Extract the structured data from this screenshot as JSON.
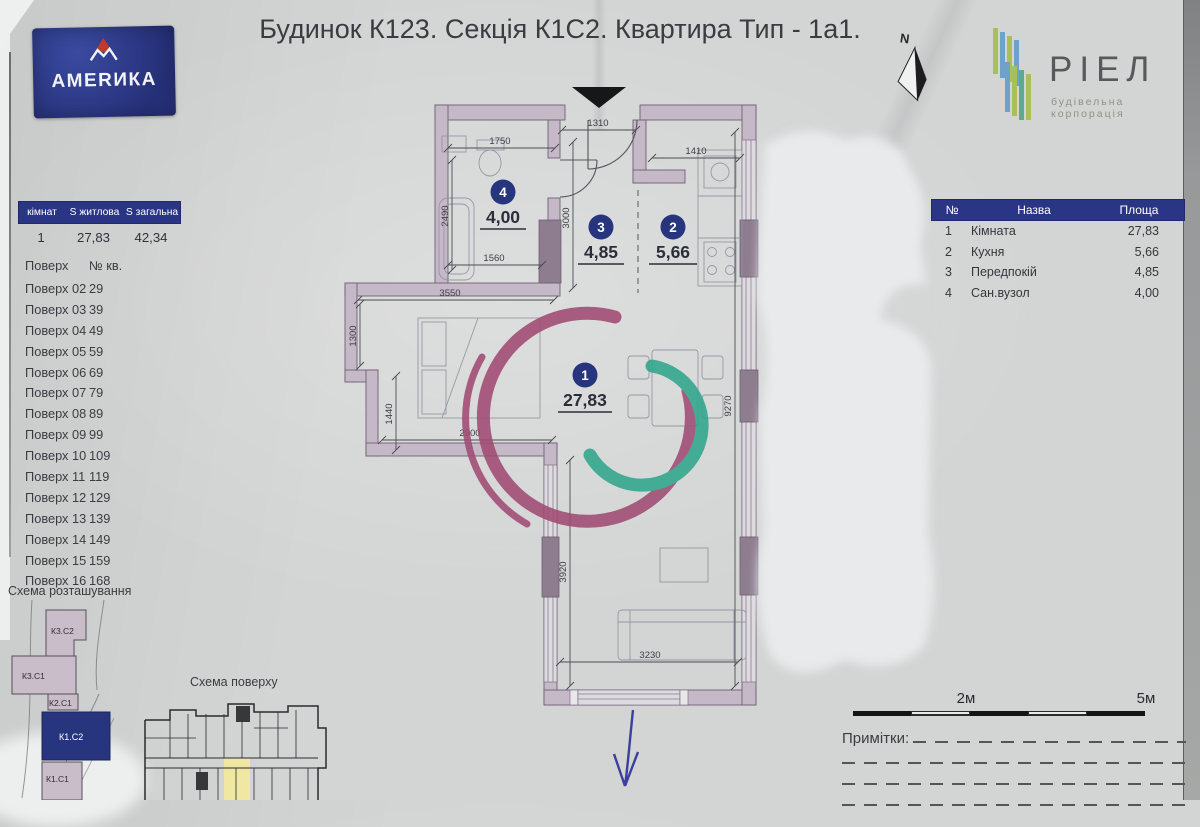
{
  "title": "Будинок К123. Секція К1С2. Квартира Тип - 1а1.",
  "amerika_logo": {
    "name": "АМЕRИКА"
  },
  "riel_logo": {
    "name": "РІЕЛ",
    "subtitle": "будівельна корпорація"
  },
  "north": {
    "label": "N"
  },
  "summary_table": {
    "headers": [
      "кімнат",
      "S житлова",
      "S загальна"
    ],
    "row": [
      "1",
      "27,83",
      "42,34"
    ]
  },
  "floors": {
    "col1": "Поверх",
    "col2": "№ кв.",
    "rows": [
      [
        "Поверх 02",
        "29"
      ],
      [
        "Поверх 03",
        "39"
      ],
      [
        "Поверх 04",
        "49"
      ],
      [
        "Поверх 05",
        "59"
      ],
      [
        "Поверх 06",
        "69"
      ],
      [
        "Поверх 07",
        "79"
      ],
      [
        "Поверх 08",
        "89"
      ],
      [
        "Поверх 09",
        "99"
      ],
      [
        "Поверх 10",
        "109"
      ],
      [
        "Поверх 11",
        "119"
      ],
      [
        "Поверх 12",
        "129"
      ],
      [
        "Поверх 13",
        "139"
      ],
      [
        "Поверх 14",
        "149"
      ],
      [
        "Поверх 15",
        "159"
      ],
      [
        "Поверх 16",
        "168"
      ]
    ]
  },
  "location_scheme": {
    "label": "Схема розташування",
    "buildings": [
      "К3.С2",
      "К3.С1",
      "К2.С1",
      "К1.С2",
      "К1.С1"
    ],
    "highlighted": "К1.С2"
  },
  "floor_scheme": {
    "label": "Схема поверху"
  },
  "plan": {
    "rooms": [
      {
        "num": "1",
        "area": "27,83"
      },
      {
        "num": "2",
        "area": "5,66"
      },
      {
        "num": "3",
        "area": "4,85"
      },
      {
        "num": "4",
        "area": "4,00"
      }
    ],
    "dims": {
      "hall_top": "1310",
      "bath_top": "1750",
      "kitchen_top": "1410",
      "bath_left": "2490",
      "bath_bottom": "1560",
      "hall_left": "3000",
      "room_top": "3550",
      "nook_left": "1300",
      "nook_left2": "1440",
      "nook_bottom": "2900",
      "right": "9270",
      "lower_left": "3920",
      "bottom": "3230"
    }
  },
  "room_table": {
    "headers": [
      "№",
      "Назва",
      "Площа"
    ],
    "rows": [
      [
        "1",
        "Кімната",
        "27,83"
      ],
      [
        "2",
        "Кухня",
        "5,66"
      ],
      [
        "3",
        "Передпокій",
        "4,85"
      ],
      [
        "4",
        "Сан.вузол",
        "4,00"
      ]
    ]
  },
  "scale_bar": {
    "label_2m": "2м",
    "label_5m": "5м"
  },
  "notes": {
    "label": "Примітки:"
  },
  "colors": {
    "accent_blue": "#2b3585",
    "wall": "#c6b9c7",
    "wall_dark": "#8d7d8e",
    "watermark_purple": "#a04a72",
    "watermark_teal": "#2fa58b",
    "highlight_yellow": "#efe7a2"
  }
}
